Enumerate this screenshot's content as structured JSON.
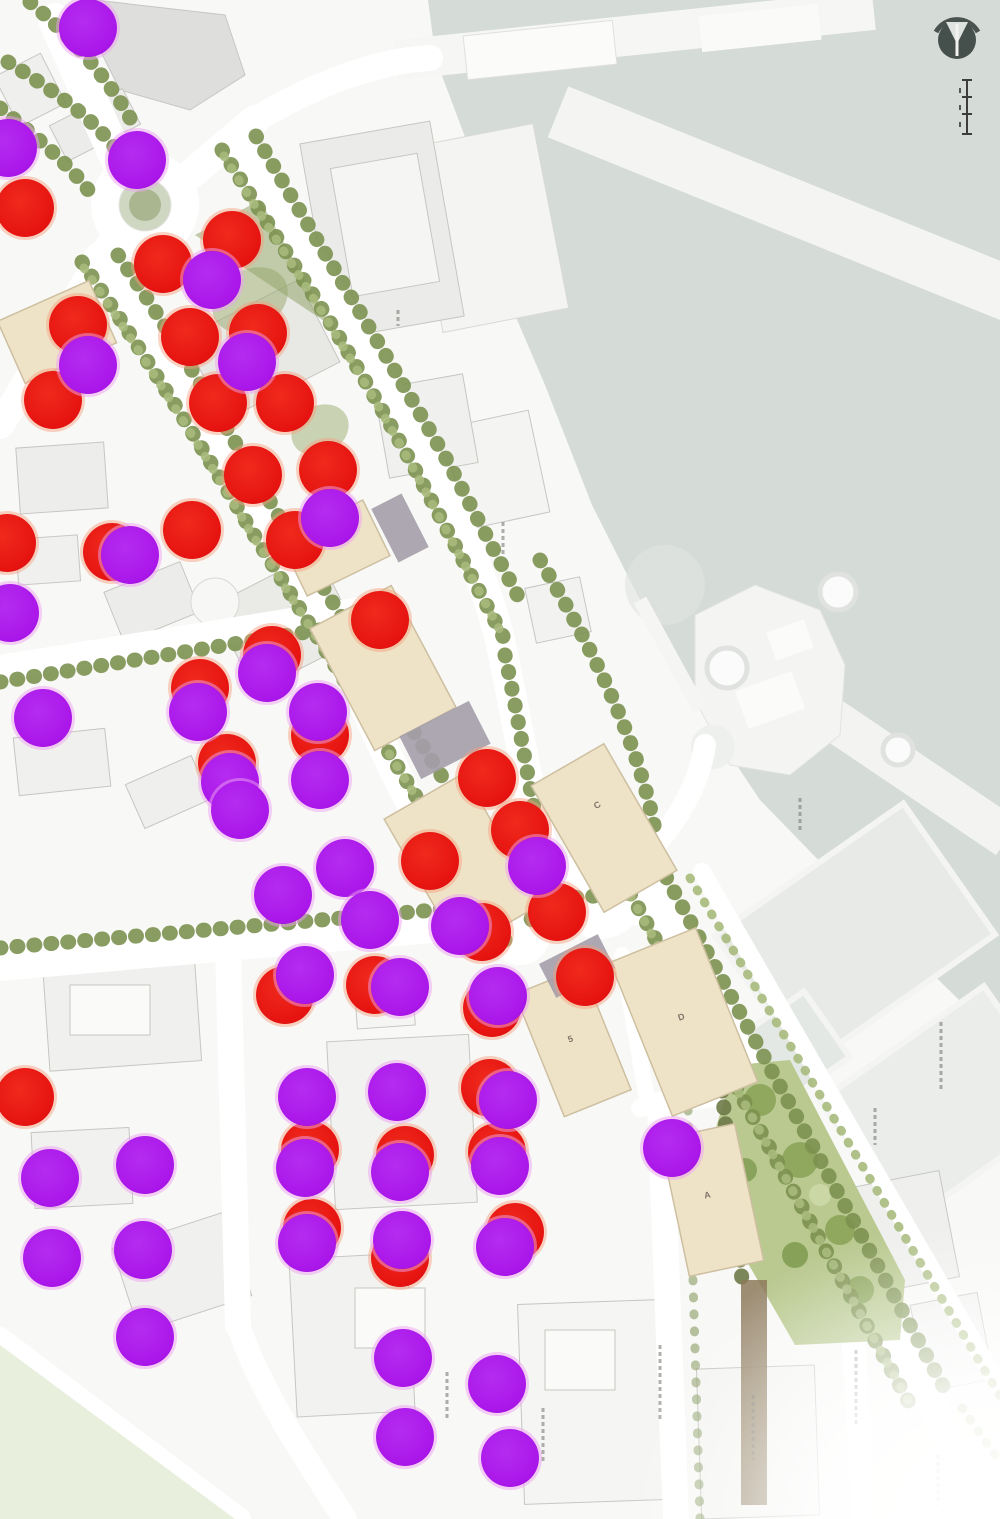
{
  "map": {
    "kind": "masterplan-site-map",
    "description": "waterfront development master plan with survey dots",
    "dot_radius": 29,
    "building_labels": [
      {
        "text": "C",
        "x": 598,
        "y": 806,
        "rot": -30
      },
      {
        "text": "5",
        "x": 572,
        "y": 1040,
        "rot": -20
      },
      {
        "text": "D",
        "x": 682,
        "y": 1018,
        "rot": -20
      },
      {
        "text": "A",
        "x": 708,
        "y": 1196,
        "rot": -12
      }
    ],
    "colors": {
      "red_dot": "#e61310",
      "purple_dot": "#aa16e9",
      "water": "#d5dbd7",
      "tan_building": "#efe3c7",
      "tree_green": "#8ea266",
      "park_green": "#b9c98f",
      "park_light_green": "#e9efdd",
      "compass_dark": "#454f4c"
    },
    "icons": {
      "north_arrow": "north-arrow-icon",
      "scale_bar": "scale-bar"
    }
  },
  "chart_data": {
    "type": "scatter",
    "title": "",
    "series": [
      {
        "name": "red-dots",
        "points": [
          [
            25,
            208
          ],
          [
            232,
            240
          ],
          [
            163,
            264
          ],
          [
            258,
            333
          ],
          [
            78,
            325
          ],
          [
            190,
            337
          ],
          [
            53,
            400
          ],
          [
            218,
            403
          ],
          [
            285,
            403
          ],
          [
            253,
            475
          ],
          [
            328,
            470
          ],
          [
            295,
            540
          ],
          [
            192,
            530
          ],
          [
            112,
            552
          ],
          [
            7,
            543
          ],
          [
            380,
            620
          ],
          [
            272,
            655
          ],
          [
            200,
            688
          ],
          [
            320,
            735
          ],
          [
            227,
            763
          ],
          [
            487,
            778
          ],
          [
            520,
            830
          ],
          [
            430,
            861
          ],
          [
            557,
            912
          ],
          [
            482,
            932
          ],
          [
            285,
            995
          ],
          [
            375,
            985
          ],
          [
            492,
            1008
          ],
          [
            585,
            977
          ],
          [
            25,
            1097
          ],
          [
            490,
            1088
          ],
          [
            310,
            1150
          ],
          [
            405,
            1155
          ],
          [
            497,
            1152
          ],
          [
            312,
            1228
          ],
          [
            400,
            1258
          ],
          [
            515,
            1232
          ]
        ]
      },
      {
        "name": "purple-dots",
        "points": [
          [
            88,
            28
          ],
          [
            8,
            148
          ],
          [
            137,
            160
          ],
          [
            212,
            280
          ],
          [
            88,
            365
          ],
          [
            247,
            362
          ],
          [
            330,
            518
          ],
          [
            130,
            555
          ],
          [
            10,
            613
          ],
          [
            43,
            718
          ],
          [
            198,
            712
          ],
          [
            267,
            673
          ],
          [
            318,
            712
          ],
          [
            320,
            780
          ],
          [
            230,
            782
          ],
          [
            240,
            810
          ],
          [
            345,
            868
          ],
          [
            283,
            895
          ],
          [
            537,
            866
          ],
          [
            370,
            920
          ],
          [
            460,
            926
          ],
          [
            305,
            975
          ],
          [
            400,
            987
          ],
          [
            498,
            996
          ],
          [
            307,
            1097
          ],
          [
            397,
            1092
          ],
          [
            508,
            1100
          ],
          [
            50,
            1178
          ],
          [
            145,
            1165
          ],
          [
            305,
            1168
          ],
          [
            400,
            1172
          ],
          [
            500,
            1166
          ],
          [
            672,
            1148
          ],
          [
            307,
            1243
          ],
          [
            402,
            1240
          ],
          [
            505,
            1247
          ],
          [
            52,
            1258
          ],
          [
            143,
            1250
          ],
          [
            145,
            1337
          ],
          [
            403,
            1358
          ],
          [
            497,
            1384
          ],
          [
            405,
            1437
          ],
          [
            510,
            1458
          ]
        ]
      }
    ],
    "x_range": [
      0,
      1000
    ],
    "y_range": [
      0,
      1519
    ]
  }
}
